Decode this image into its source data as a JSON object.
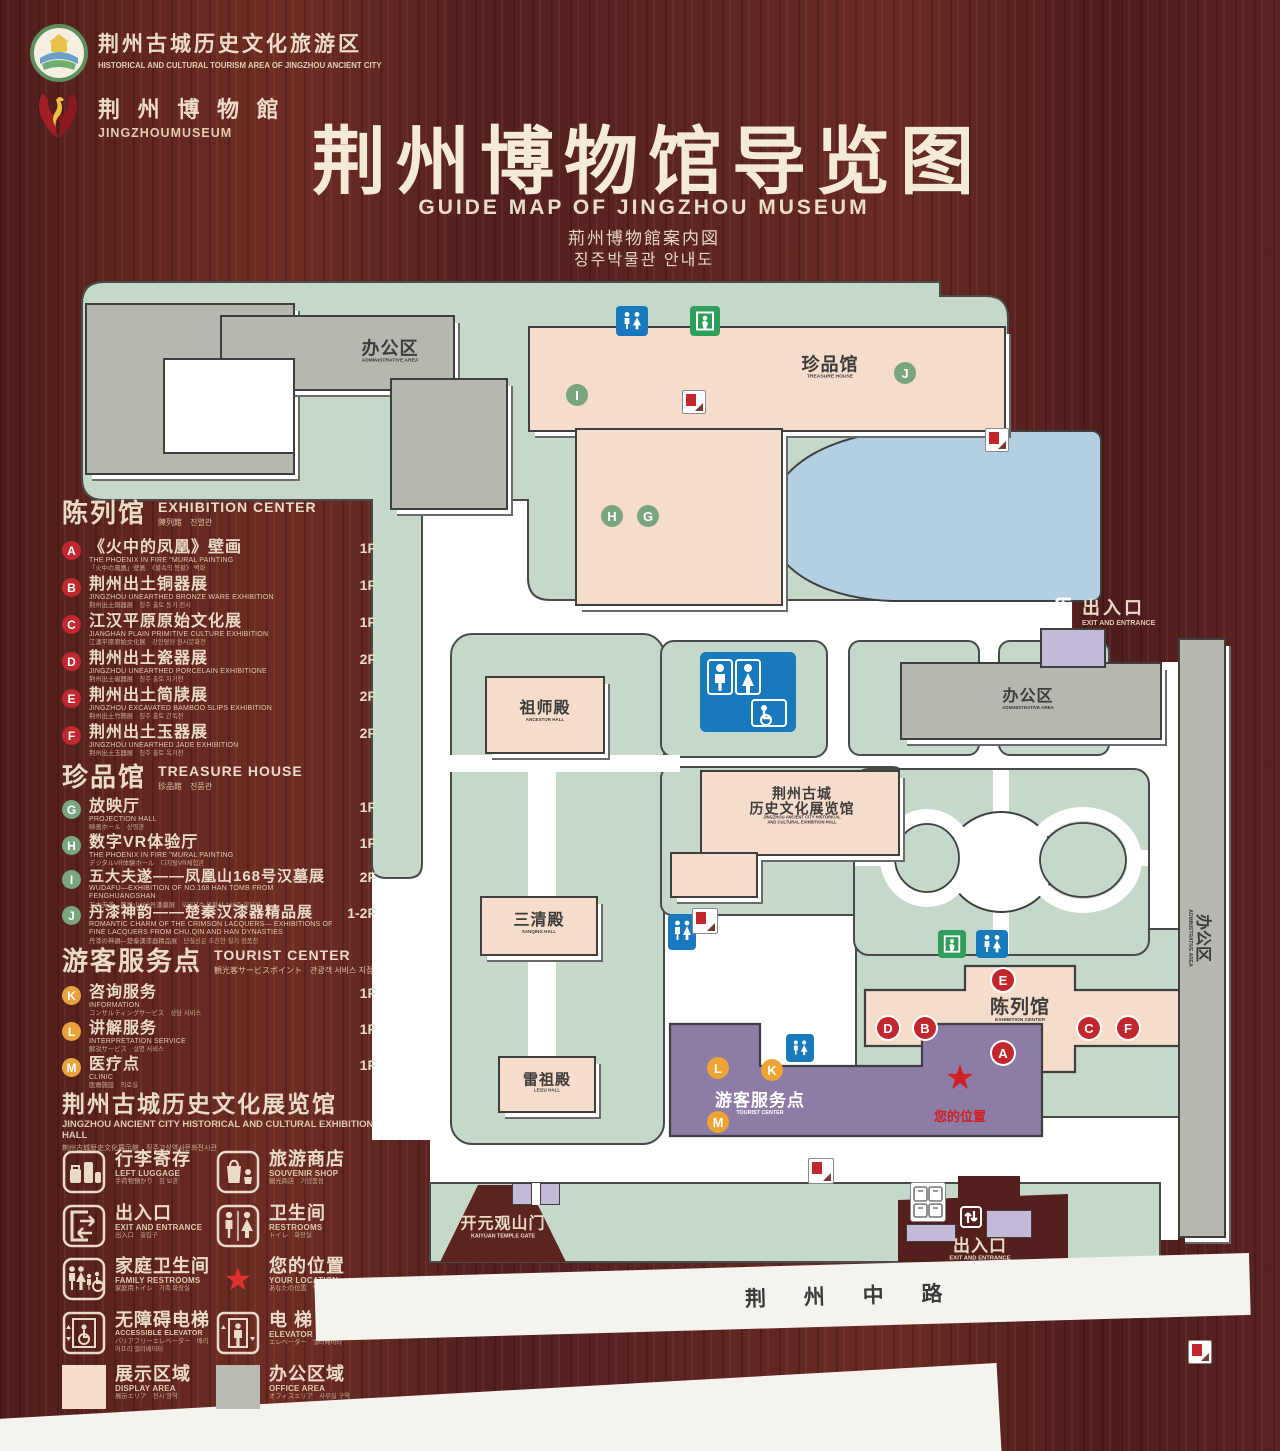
{
  "logos": {
    "tourism": {
      "cn": "荆州古城历史文化旅游区",
      "en": "HISTORICAL AND CULTURAL TOURISM AREA OF JINGZHOU ANCIENT CITY"
    },
    "museum": {
      "cn": "荆 州 博 物 館",
      "en": "JINGZHOUMUSEUM"
    }
  },
  "title": {
    "cn": "荆州博物馆导览图",
    "en": "GUIDE MAP OF JINGZHOU MUSEUM",
    "jp": "荊州博物館案内図",
    "kr": "징주박물관 안내도"
  },
  "legend": {
    "sections": [
      {
        "title_cn": "陈列馆",
        "title_en": "EXHIBITION CENTER",
        "title_sub": "陳列館　진열관",
        "items": [
          {
            "letter": "A",
            "cn": "《火中的凤凰》壁画",
            "en": "THE PHOENIX IN FIRE \"MURAL PAINTING",
            "sub": "「火中の鳳凰」壁画　《불속의 봉황》 벽화",
            "floor": "1F"
          },
          {
            "letter": "B",
            "cn": "荆州出土铜器展",
            "en": "JINGZHOU UNEARTHED BRONZE WARE EXHIBITION",
            "sub": "荆州出土銅器展　징주 출토 동기 전시",
            "floor": "1F"
          },
          {
            "letter": "C",
            "cn": "江汉平原原始文化展",
            "en": "JIANGHAN PLAIN PRIMITIVE CULTURE EXHIBITION",
            "sub": "江漢平原原始文化展　강한평원 원시문화전",
            "floor": "1F"
          },
          {
            "letter": "D",
            "cn": "荆州出土瓷器展",
            "en": "JINGZHOU UNEARTHED PORCELAIN EXHIBITIONE",
            "sub": "荆州出土磁器展　징주 출토 자기전",
            "floor": "2F"
          },
          {
            "letter": "E",
            "cn": "荆州出土简牍展",
            "en": "JINGZHOU EXCAVATED BAMBOO SLIPS EXHIBITION",
            "sub": "荆州出土竹簡展　징주 출토 간독전",
            "floor": "2F"
          },
          {
            "letter": "F",
            "cn": "荆州出土玉器展",
            "en": "JINGZHOU UNEARTHED JADE EXHIBITION",
            "sub": "荆州出土玉器展　징주 출토 옥기전",
            "floor": "2F"
          }
        ]
      },
      {
        "title_cn": "珍品馆",
        "title_en": "TREASURE HOUSE",
        "title_sub": "珍品館　진품관",
        "items": [
          {
            "letter": "G",
            "cn": "放映厅",
            "en": "PROJECTION HALL",
            "sub": "映画ホール　상영관",
            "floor": "1F"
          },
          {
            "letter": "H",
            "cn": "数字VR体验厅",
            "en": "THE PHOENIX IN FIRE \"MURAL PAINTING",
            "sub": "デジタルVR体験ホール　디지털VR체험관",
            "floor": "1F"
          },
          {
            "letter": "I",
            "cn": "五大夫遂——凤凰山168号汉墓展",
            "en": "WUDAFU—EXHIBITION OF NO.168 HAN TOMB FROM FENGHUANGSHAN",
            "sub": "五大夫遂—鳳凰山168号漢墓展　오대부수 봉황산 168호 한묘전",
            "floor": "2F"
          },
          {
            "letter": "J",
            "cn": "丹漆神韵——楚秦汉漆器精品展",
            "en": "ROMANTIC CHARM OF THE CRIMSON LACQUERS— EXHIBITIONS OF FINE LACQUERS FROM CHU,QIN AND HAN DYNASTIES",
            "sub": "丹漆の神韻—楚秦漢漆器精品展　단칠신운 초진한 칠기 정품전",
            "floor": "1-2F"
          }
        ]
      },
      {
        "title_cn": "游客服务点",
        "title_en": "TOURIST CENTER",
        "title_sub": "観光客サービスポイント　관광객 서비스 지점",
        "items": [
          {
            "letter": "K",
            "cn": "咨询服务",
            "en": "INFORMATION",
            "sub": "コンサルティングサービス　상담 서비스",
            "floor": "1F"
          },
          {
            "letter": "L",
            "cn": "讲解服务",
            "en": "INTERPRETATION SERVICE",
            "sub": "解説サービス　설명 서비스",
            "floor": "1F"
          },
          {
            "letter": "M",
            "cn": "医疗点",
            "en": "CLINIC",
            "sub": "医療施設　의료실",
            "floor": "1F"
          }
        ]
      }
    ],
    "hall": {
      "cn": "荆州古城历史文化展览馆",
      "en": "JINGZHOU ANCIENT CITY HISTORICAL AND CULTURAL EXHIBITION HALL",
      "sub": "荆州古城歴史文化展示館　징주고성역사문화전시관"
    },
    "icons": [
      {
        "cn": "行李寄存",
        "en": "LEFT LUGGAGE",
        "sub": "手荷物預かり　짐 보관"
      },
      {
        "cn": "旅游商店",
        "en": "SOUVENIR SHOP",
        "sub": "観光商店　기념품점"
      },
      {
        "cn": "出入口",
        "en": "EXIT AND ENTRANCE",
        "sub": "出入口　출입구"
      },
      {
        "cn": "卫生间",
        "en": "RESTROOMS",
        "sub": "トイレ　화장실"
      },
      {
        "cn": "家庭卫生间",
        "en": "FAMILY RESTROOMS",
        "sub": "家庭用トイレ　가족 화장실"
      },
      {
        "cn": "您的位置",
        "en": "YOUR LOCATION",
        "sub": "あなたの位置　당신의 위치"
      },
      {
        "cn": "无障碍电梯",
        "en": "ACCESSIBLE ELEVATOR",
        "sub": "バリアフリーエレベーター　배리어프리 엘리베이터"
      },
      {
        "cn": "电  梯",
        "en": "ELEVATOR",
        "sub": "エレベーター　엘리베이터"
      },
      {
        "cn": "展示区域",
        "en": "DISPLAY AREA",
        "sub": "展示エリア　전시 영역"
      },
      {
        "cn": "办公区域",
        "en": "OFFICE AREA",
        "sub": "オフィスエリア　사무실 구역"
      }
    ]
  },
  "map": {
    "admin_area": {
      "cn": "办公区",
      "en": "ADMINISTRATIVE AREA"
    },
    "treasure_house": {
      "cn": "珍品馆",
      "en": "TREASURE HOUSE"
    },
    "ancestor_hall": {
      "cn": "祖师殿",
      "en": "ANCESTOR HALL"
    },
    "sanqing_hall": {
      "cn": "三清殿",
      "en": "SANQING HALL"
    },
    "leizu_hall": {
      "cn": "雷祖殿",
      "en": "LEIZU HALL"
    },
    "exhibition_hall": {
      "cn1": "荆州古城",
      "cn2": "历史文化展览馆",
      "en1": "JINGZHOU ANCIENT CITY HISTORICAL",
      "en2": "AND CULTURAL EXHIBITION HALL"
    },
    "exhibition_center": {
      "cn": "陈列馆",
      "en": "EXHIBITION CENTER"
    },
    "tourist_center": {
      "cn": "游客服务点",
      "en": "TOURIST CENTER"
    },
    "entrance": {
      "cn": "出入口",
      "en": "EXIT AND ENTRANCE"
    },
    "kaiyuan_gate": {
      "cn": "开元观山门",
      "en": "KAIYUAN TEMPLE GATE"
    },
    "your_location": "您的位置",
    "road": "荆 州 中 路",
    "markers": {
      "a": "A",
      "b": "B",
      "c": "C",
      "d": "D",
      "e": "E",
      "f": "F",
      "g": "G",
      "h": "H",
      "i": "I",
      "j": "J",
      "k": "K",
      "l": "L",
      "m": "M"
    }
  },
  "colors": {
    "wood": "#5a2321",
    "map_green": "#c6d8ca",
    "display_area_pink": "#f6dcca",
    "office_gray": "#b6b7af",
    "tourist_purple": "#8c7ca6",
    "gate_purple": "#c4b9d6",
    "lake_blue": "#b3cfe2",
    "restroom_blue": "#1879bc",
    "exit_green": "#2e9e5b",
    "marker_red": "#c2272d",
    "marker_green": "#79a57f",
    "marker_orange": "#eda432",
    "location_red": "#d21f26",
    "cream_text": "#eadbc6"
  }
}
